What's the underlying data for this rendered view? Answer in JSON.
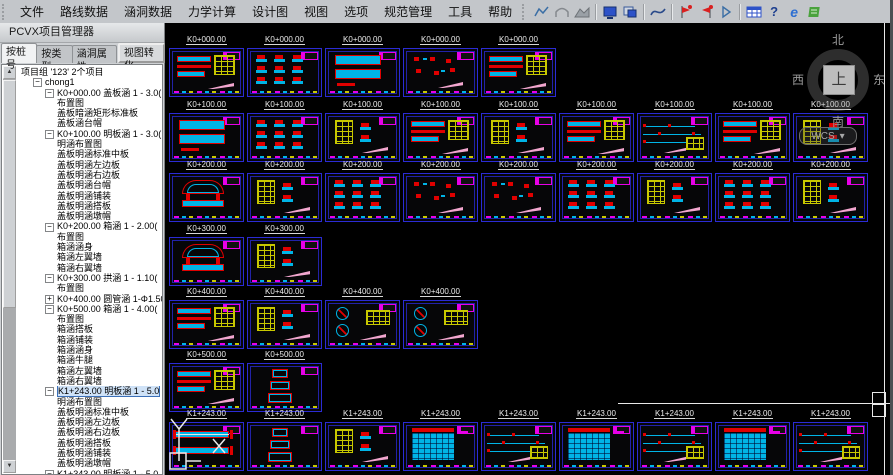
{
  "menu": {
    "items": [
      "文件",
      "路线数据",
      "涵洞数据",
      "力学计算",
      "设计图",
      "视图",
      "选项",
      "规范管理",
      "工具",
      "帮助"
    ]
  },
  "toolbar": {
    "groups": [
      [
        "trend-chart-icon",
        "culvert-shape-icon",
        "area-chart-icon"
      ],
      [
        "display-icon",
        "layout-windows-icon"
      ],
      [
        "section-curve-icon"
      ],
      [
        "check-flag-icon",
        "check-flag-alt-icon",
        "play-icon"
      ],
      [
        "table-grid-icon",
        "help-icon",
        "browser-icon",
        "notes-icon"
      ]
    ]
  },
  "panel": {
    "title": "PCVX项目管理器",
    "tabs": [
      "按桩号",
      "按类型",
      "涵洞属性",
      "视图转化"
    ],
    "active_tab": 0,
    "tree": [
      {
        "label": "项目组 '123' 2个项目",
        "level": 0,
        "exp": "none"
      },
      {
        "label": "chong1",
        "level": 1,
        "exp": "minus"
      },
      {
        "label": "K0+000.00 盖板涵 1 - 3.0(",
        "level": 2,
        "exp": "minus"
      },
      {
        "label": "布置图",
        "level": 3,
        "exp": "none"
      },
      {
        "label": "盖板暗涵矩形标准板",
        "level": 3,
        "exp": "none"
      },
      {
        "label": "盖板涵台帽",
        "level": 3,
        "exp": "none"
      },
      {
        "label": "K0+100.00 明板涵 1 - 3.0(",
        "level": 2,
        "exp": "minus"
      },
      {
        "label": "明涵布置图",
        "level": 3,
        "exp": "none"
      },
      {
        "label": "盖板明涵标准中板",
        "level": 3,
        "exp": "none"
      },
      {
        "label": "盖板明涵左边板",
        "level": 3,
        "exp": "none"
      },
      {
        "label": "盖板明涵右边板",
        "level": 3,
        "exp": "none"
      },
      {
        "label": "盖板明涵台帽",
        "level": 3,
        "exp": "none"
      },
      {
        "label": "盖板明涵铺装",
        "level": 3,
        "exp": "none"
      },
      {
        "label": "盖板明涵搭板",
        "level": 3,
        "exp": "none"
      },
      {
        "label": "盖板明涵墩帽",
        "level": 3,
        "exp": "none"
      },
      {
        "label": "K0+200.00 箱涵 1 - 2.00(",
        "level": 2,
        "exp": "minus"
      },
      {
        "label": "布置图",
        "level": 3,
        "exp": "none"
      },
      {
        "label": "箱涵涵身",
        "level": 3,
        "exp": "none"
      },
      {
        "label": "箱涵左翼墙",
        "level": 3,
        "exp": "none"
      },
      {
        "label": "箱涵右翼墙",
        "level": 3,
        "exp": "none"
      },
      {
        "label": "K0+300.00 拱涵 1 - 1.10(",
        "level": 2,
        "exp": "minus"
      },
      {
        "label": "布置图",
        "level": 3,
        "exp": "none"
      },
      {
        "label": "K0+400.00 圆管涵 1-Φ1.50",
        "level": 2,
        "exp": "plus"
      },
      {
        "label": "K0+500.00 箱涵 1 - 4.00(",
        "level": 2,
        "exp": "minus"
      },
      {
        "label": "布置图",
        "level": 3,
        "exp": "none"
      },
      {
        "label": "箱涵搭板",
        "level": 3,
        "exp": "none"
      },
      {
        "label": "箱涵铺装",
        "level": 3,
        "exp": "none"
      },
      {
        "label": "箱涵涵身",
        "level": 3,
        "exp": "none"
      },
      {
        "label": "箱涵牛腿",
        "level": 3,
        "exp": "none"
      },
      {
        "label": "箱涵左翼墙",
        "level": 3,
        "exp": "none"
      },
      {
        "label": "箱涵右翼墙",
        "level": 3,
        "exp": "none"
      },
      {
        "label": "K1+243.00 明板涵 1 - 5.0",
        "level": 2,
        "exp": "minus",
        "sel": true
      },
      {
        "label": "明涵布置图",
        "level": 3,
        "exp": "none"
      },
      {
        "label": "盖板明涵标准中板",
        "level": 3,
        "exp": "none"
      },
      {
        "label": "盖板明涵左边板",
        "level": 3,
        "exp": "none"
      },
      {
        "label": "盖板明涵右边板",
        "level": 3,
        "exp": "none"
      },
      {
        "label": "盖板明涵搭板",
        "level": 3,
        "exp": "none"
      },
      {
        "label": "盖板明涵铺装",
        "level": 3,
        "exp": "none"
      },
      {
        "label": "盖板明涵墩帽",
        "level": 3,
        "exp": "none"
      },
      {
        "label": "K1+343.00 明板涵 1 - 5.0",
        "level": 2,
        "exp": "minus"
      }
    ]
  },
  "canvas": {
    "compass": {
      "north": "北",
      "south": "南",
      "west": "西",
      "east": "东",
      "top": "上",
      "wcs": "WCS",
      "arrow": "▾"
    },
    "rows": [
      {
        "station": "K0+000.00",
        "thumbs": [
          "assembly",
          "parts",
          "sections",
          "sparse",
          "assembly"
        ]
      },
      {
        "station": "K0+100.00",
        "thumbs": [
          "sections",
          "parts",
          "table",
          "assembly",
          "table",
          "assembly",
          "lines",
          "assembly",
          "table"
        ]
      },
      {
        "station": "K0+200.00",
        "thumbs": [
          "arch",
          "table",
          "parts",
          "sparse",
          "sparse",
          "parts",
          "table",
          "parts",
          "table"
        ]
      },
      {
        "station": "K0+300.00",
        "thumbs": [
          "arch",
          "table"
        ]
      },
      {
        "station": "K0+400.00",
        "thumbs": [
          "assembly",
          "table",
          "circles",
          "circles"
        ]
      },
      {
        "station": "K0+500.00",
        "thumbs": [
          "assembly",
          "boxes"
        ]
      },
      {
        "station": "K1+243.00",
        "thumbs": [
          "plan",
          "boxes",
          "table",
          "rebar",
          "lines",
          "rebar",
          "lines",
          "rebar",
          "lines"
        ]
      }
    ]
  },
  "colors": {
    "cad_cyan": "#00b4e6",
    "cad_red": "#e00000",
    "cad_yellow": "#c8c800",
    "cad_magenta": "#e800e8",
    "cad_pink": "#f2a6cf",
    "cad_white": "#e8e8e8",
    "thumb_border": "#2b2bd5",
    "canvas_bg": "#000000"
  }
}
